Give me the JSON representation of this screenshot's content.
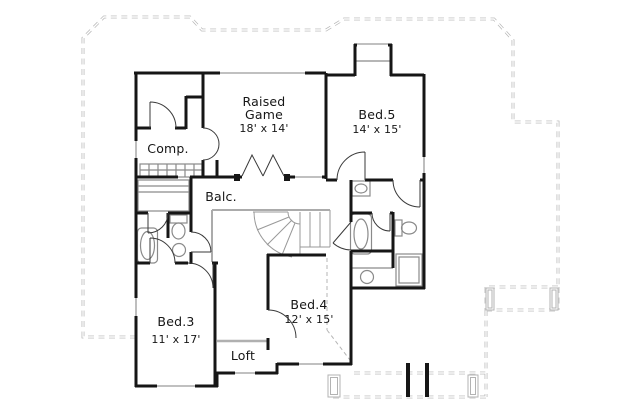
{
  "figure": {
    "type": "house-floor-plan",
    "style": "black walls, gray fixtures, dashed gray roof and porch outlines"
  },
  "rooms": {
    "raised_game": {
      "name": "Raised Game",
      "name_line1": "Raised",
      "name_line2": "Game",
      "dims": "18' x 14'"
    },
    "bed5": {
      "name": "Bed.5",
      "dims": "14' x 15'"
    },
    "comp": {
      "name": "Comp."
    },
    "balc": {
      "name": "Balc."
    },
    "bed3": {
      "name": "Bed.3",
      "dims": "11' x 17'"
    },
    "bed4": {
      "name": "Bed.4",
      "dims": "12' x 15'"
    },
    "loft": {
      "name": "Loft"
    }
  },
  "elements": [
    "curved-staircase",
    "balcony-railing",
    "loft-railing",
    "bathtub-icon",
    "toilet-icon",
    "sink-icon",
    "closet-shelves",
    "built-in-desk",
    "chimney",
    "porch-posts",
    "roof-outline",
    "windows",
    "door-swing-arcs",
    "french-doors",
    "bay-window"
  ],
  "colors": {
    "wall": "#161616",
    "text": "#161616",
    "fixture_gray": "#8a8a8a",
    "stair_gray": "#999999",
    "roofline_gray": "#b3b3b3",
    "window_gray": "#9a9a9a",
    "background": "#ffffff"
  }
}
